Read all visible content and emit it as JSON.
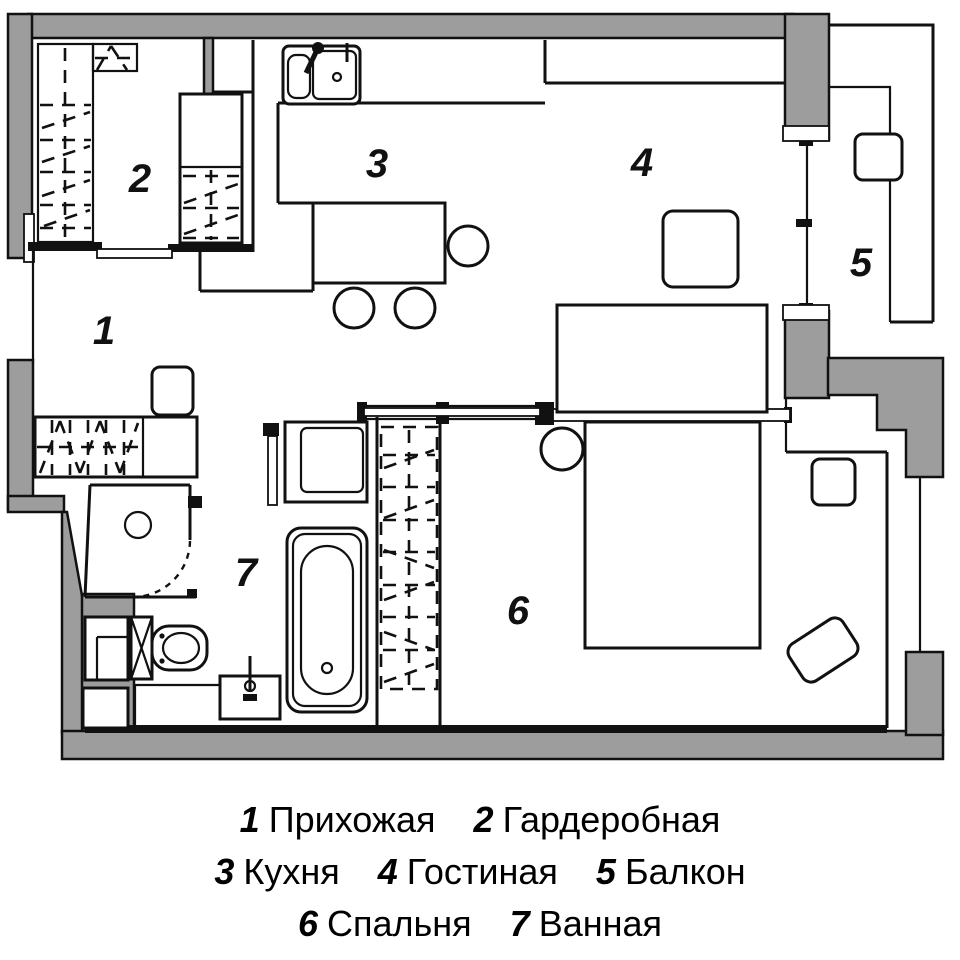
{
  "colors": {
    "wall_fill": "#9d9d9d",
    "line": "#111111",
    "background": "#ffffff"
  },
  "rooms": [
    {
      "number": "1",
      "name": "Прихожая"
    },
    {
      "number": "2",
      "name": "Гардеробная"
    },
    {
      "number": "3",
      "name": "Кухня"
    },
    {
      "number": "4",
      "name": "Гостиная"
    },
    {
      "number": "5",
      "name": "Балкон"
    },
    {
      "number": "6",
      "name": "Спальня"
    },
    {
      "number": "7",
      "name": "Ванная"
    }
  ],
  "fixtures": [
    "kitchen-sink",
    "bar-stool",
    "kitchen-island",
    "wardrobe-shelving",
    "wardrobe-cabinet",
    "hall-closet",
    "shoe-cabinet",
    "sliding-door",
    "shower-cabin",
    "toilet",
    "vanity-sink",
    "bathtub",
    "washing-machine",
    "utility-shaft",
    "bed",
    "armchair",
    "nightstand",
    "pouf",
    "wardrobe-column",
    "sofa",
    "coffee-table",
    "balcony-stool",
    "balcony-glazing",
    "window"
  ]
}
